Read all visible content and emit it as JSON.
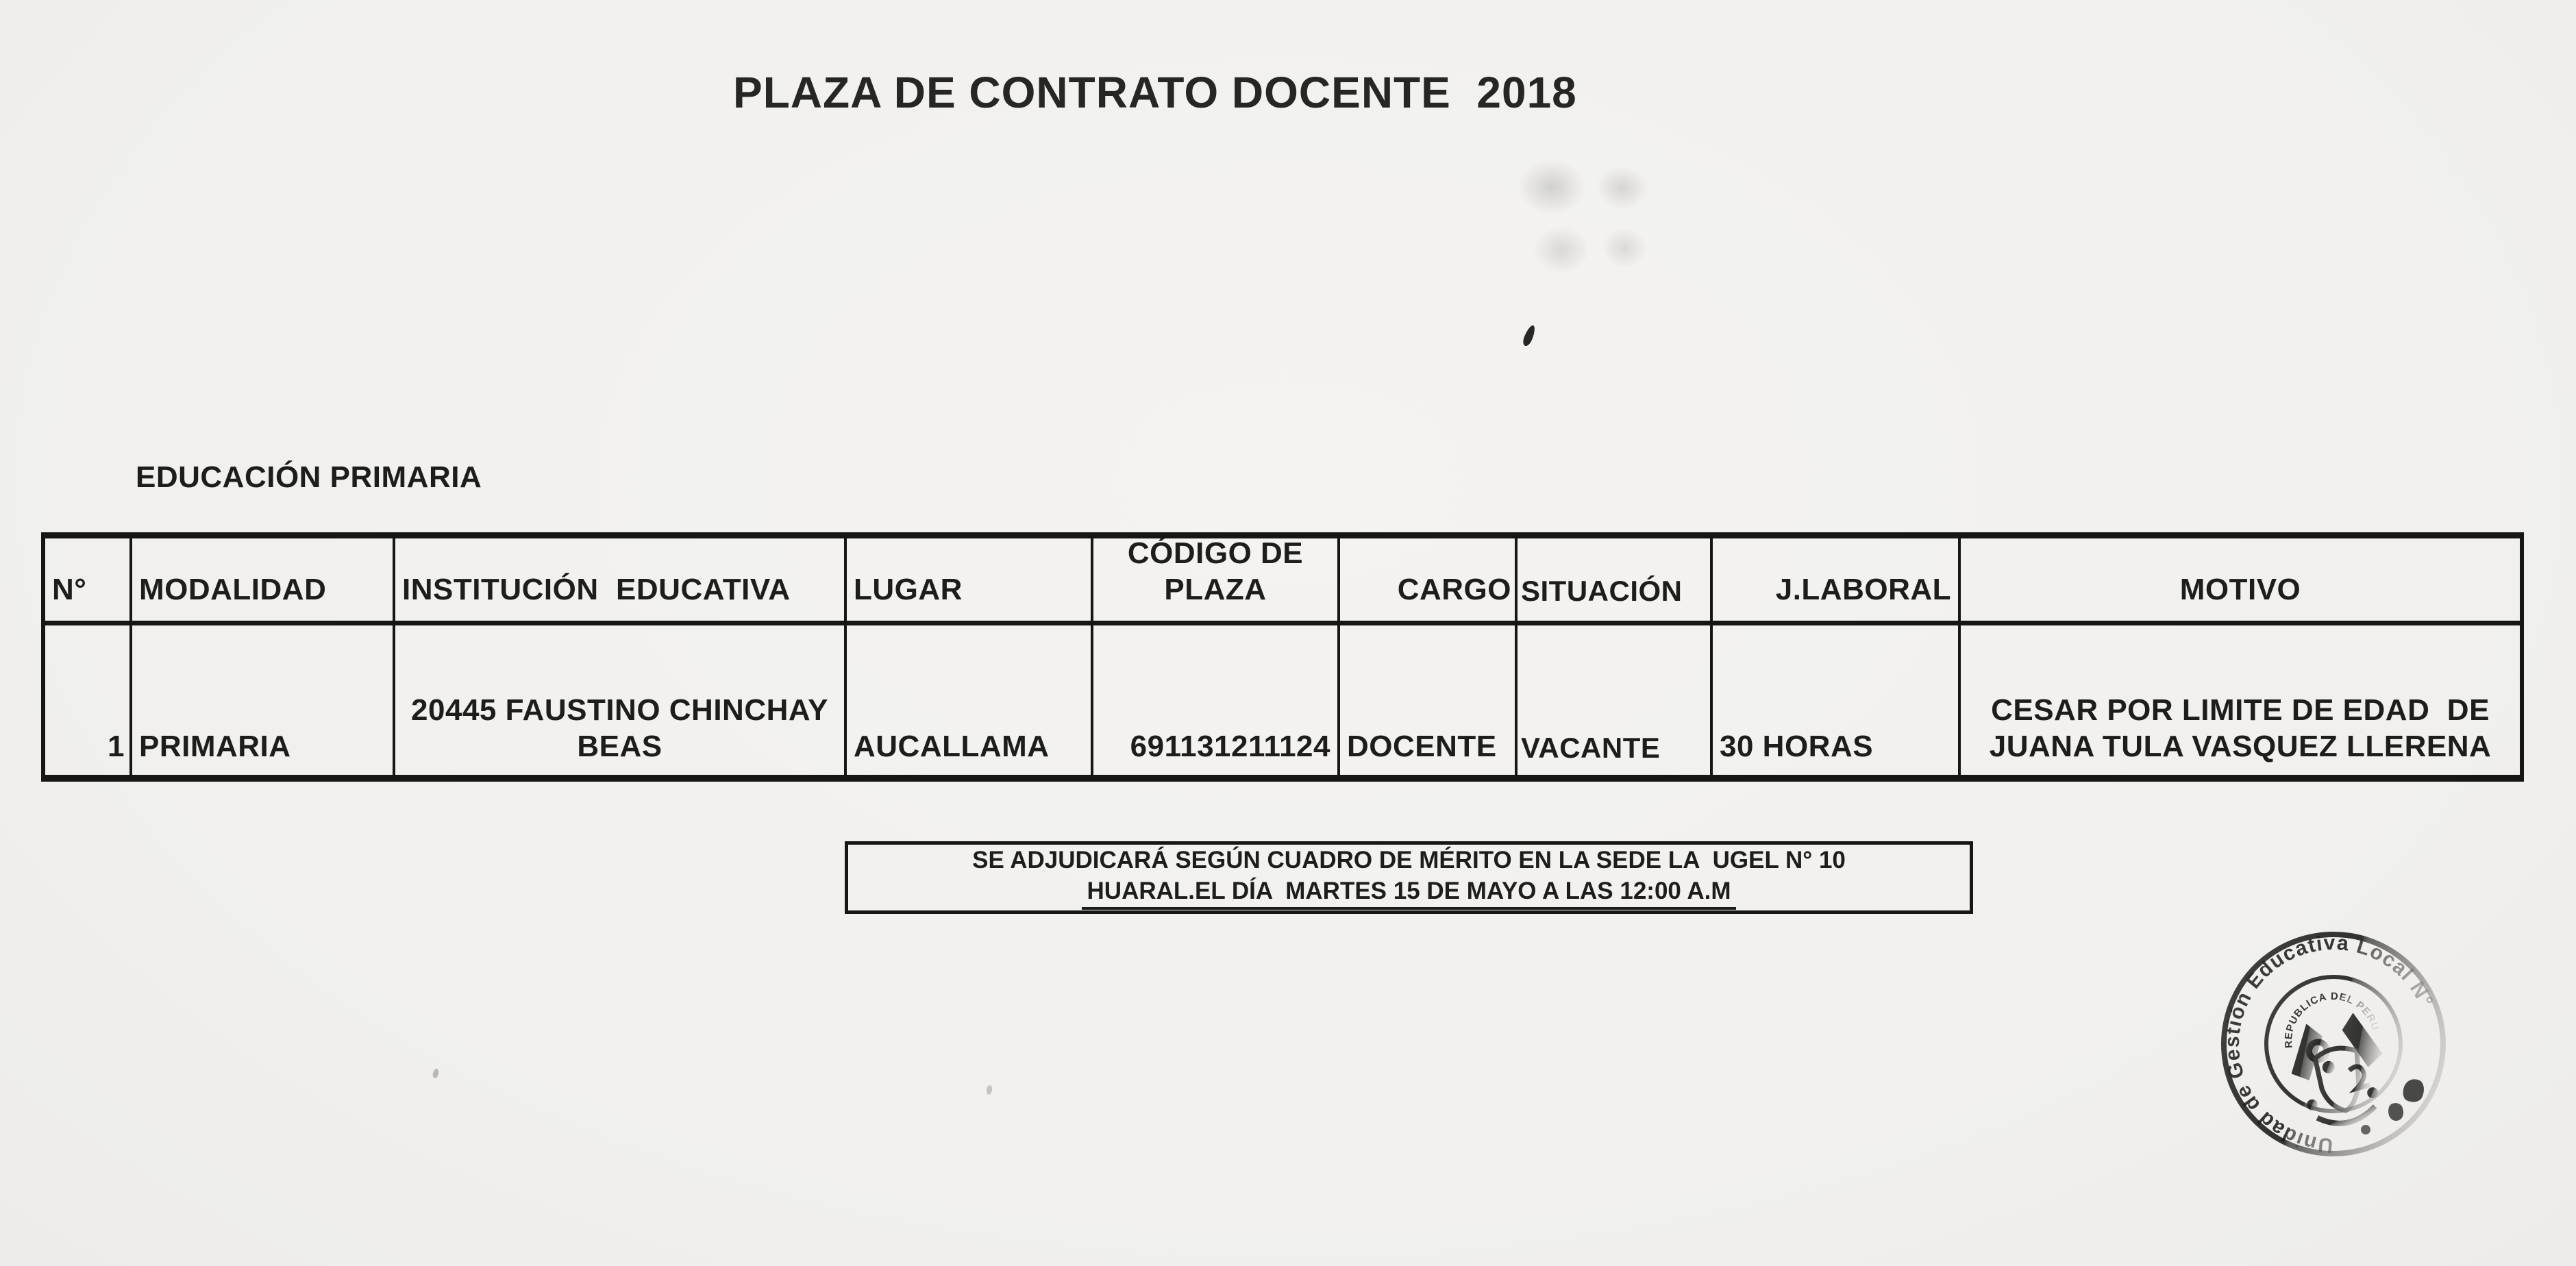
{
  "document": {
    "title": "PLAZA DE CONTRATO DOCENTE  2018",
    "section_heading": "EDUCACIÓN PRIMARIA"
  },
  "table": {
    "headers": {
      "numero": "N°",
      "modalidad": "MODALIDAD",
      "institucion": "INSTITUCIÓN  EDUCATIVA",
      "lugar": "LUGAR",
      "codigo": "CÓDIGO DE PLAZA",
      "cargo": "CARGO",
      "situacion": "SITUACIÓN",
      "jlaboral": "J.LABORAL",
      "motivo": "MOTIVO"
    },
    "rows": [
      {
        "numero": "1",
        "modalidad": "PRIMARIA",
        "institucion": "20445 FAUSTINO CHINCHAY BEAS",
        "lugar": "AUCALLAMA",
        "codigo": "691131211124",
        "cargo": "DOCENTE",
        "situacion": "VACANTE",
        "jlaboral": "30 HORAS",
        "motivo": "CESAR POR LIMITE DE EDAD  DE JUANA TULA VASQUEZ LLERENA"
      }
    ]
  },
  "notice": {
    "line1": "SE ADJUDICARÁ SEGÚN CUADRO DE MÉRITO EN LA SEDE LA  UGEL N° 10",
    "line2": "HUARAL.EL DÍA  MARTES 15 DE MAYO A LAS 12:00 A.M"
  },
  "stamp": {
    "ring_text": "Unidad de Gestión Educativa Local N°",
    "center_text": "REPUBLICA DEL PERU"
  },
  "colors": {
    "paper": "#f2f1ef",
    "ink": "#1d1d1b",
    "stamp_ink": "#343432"
  }
}
